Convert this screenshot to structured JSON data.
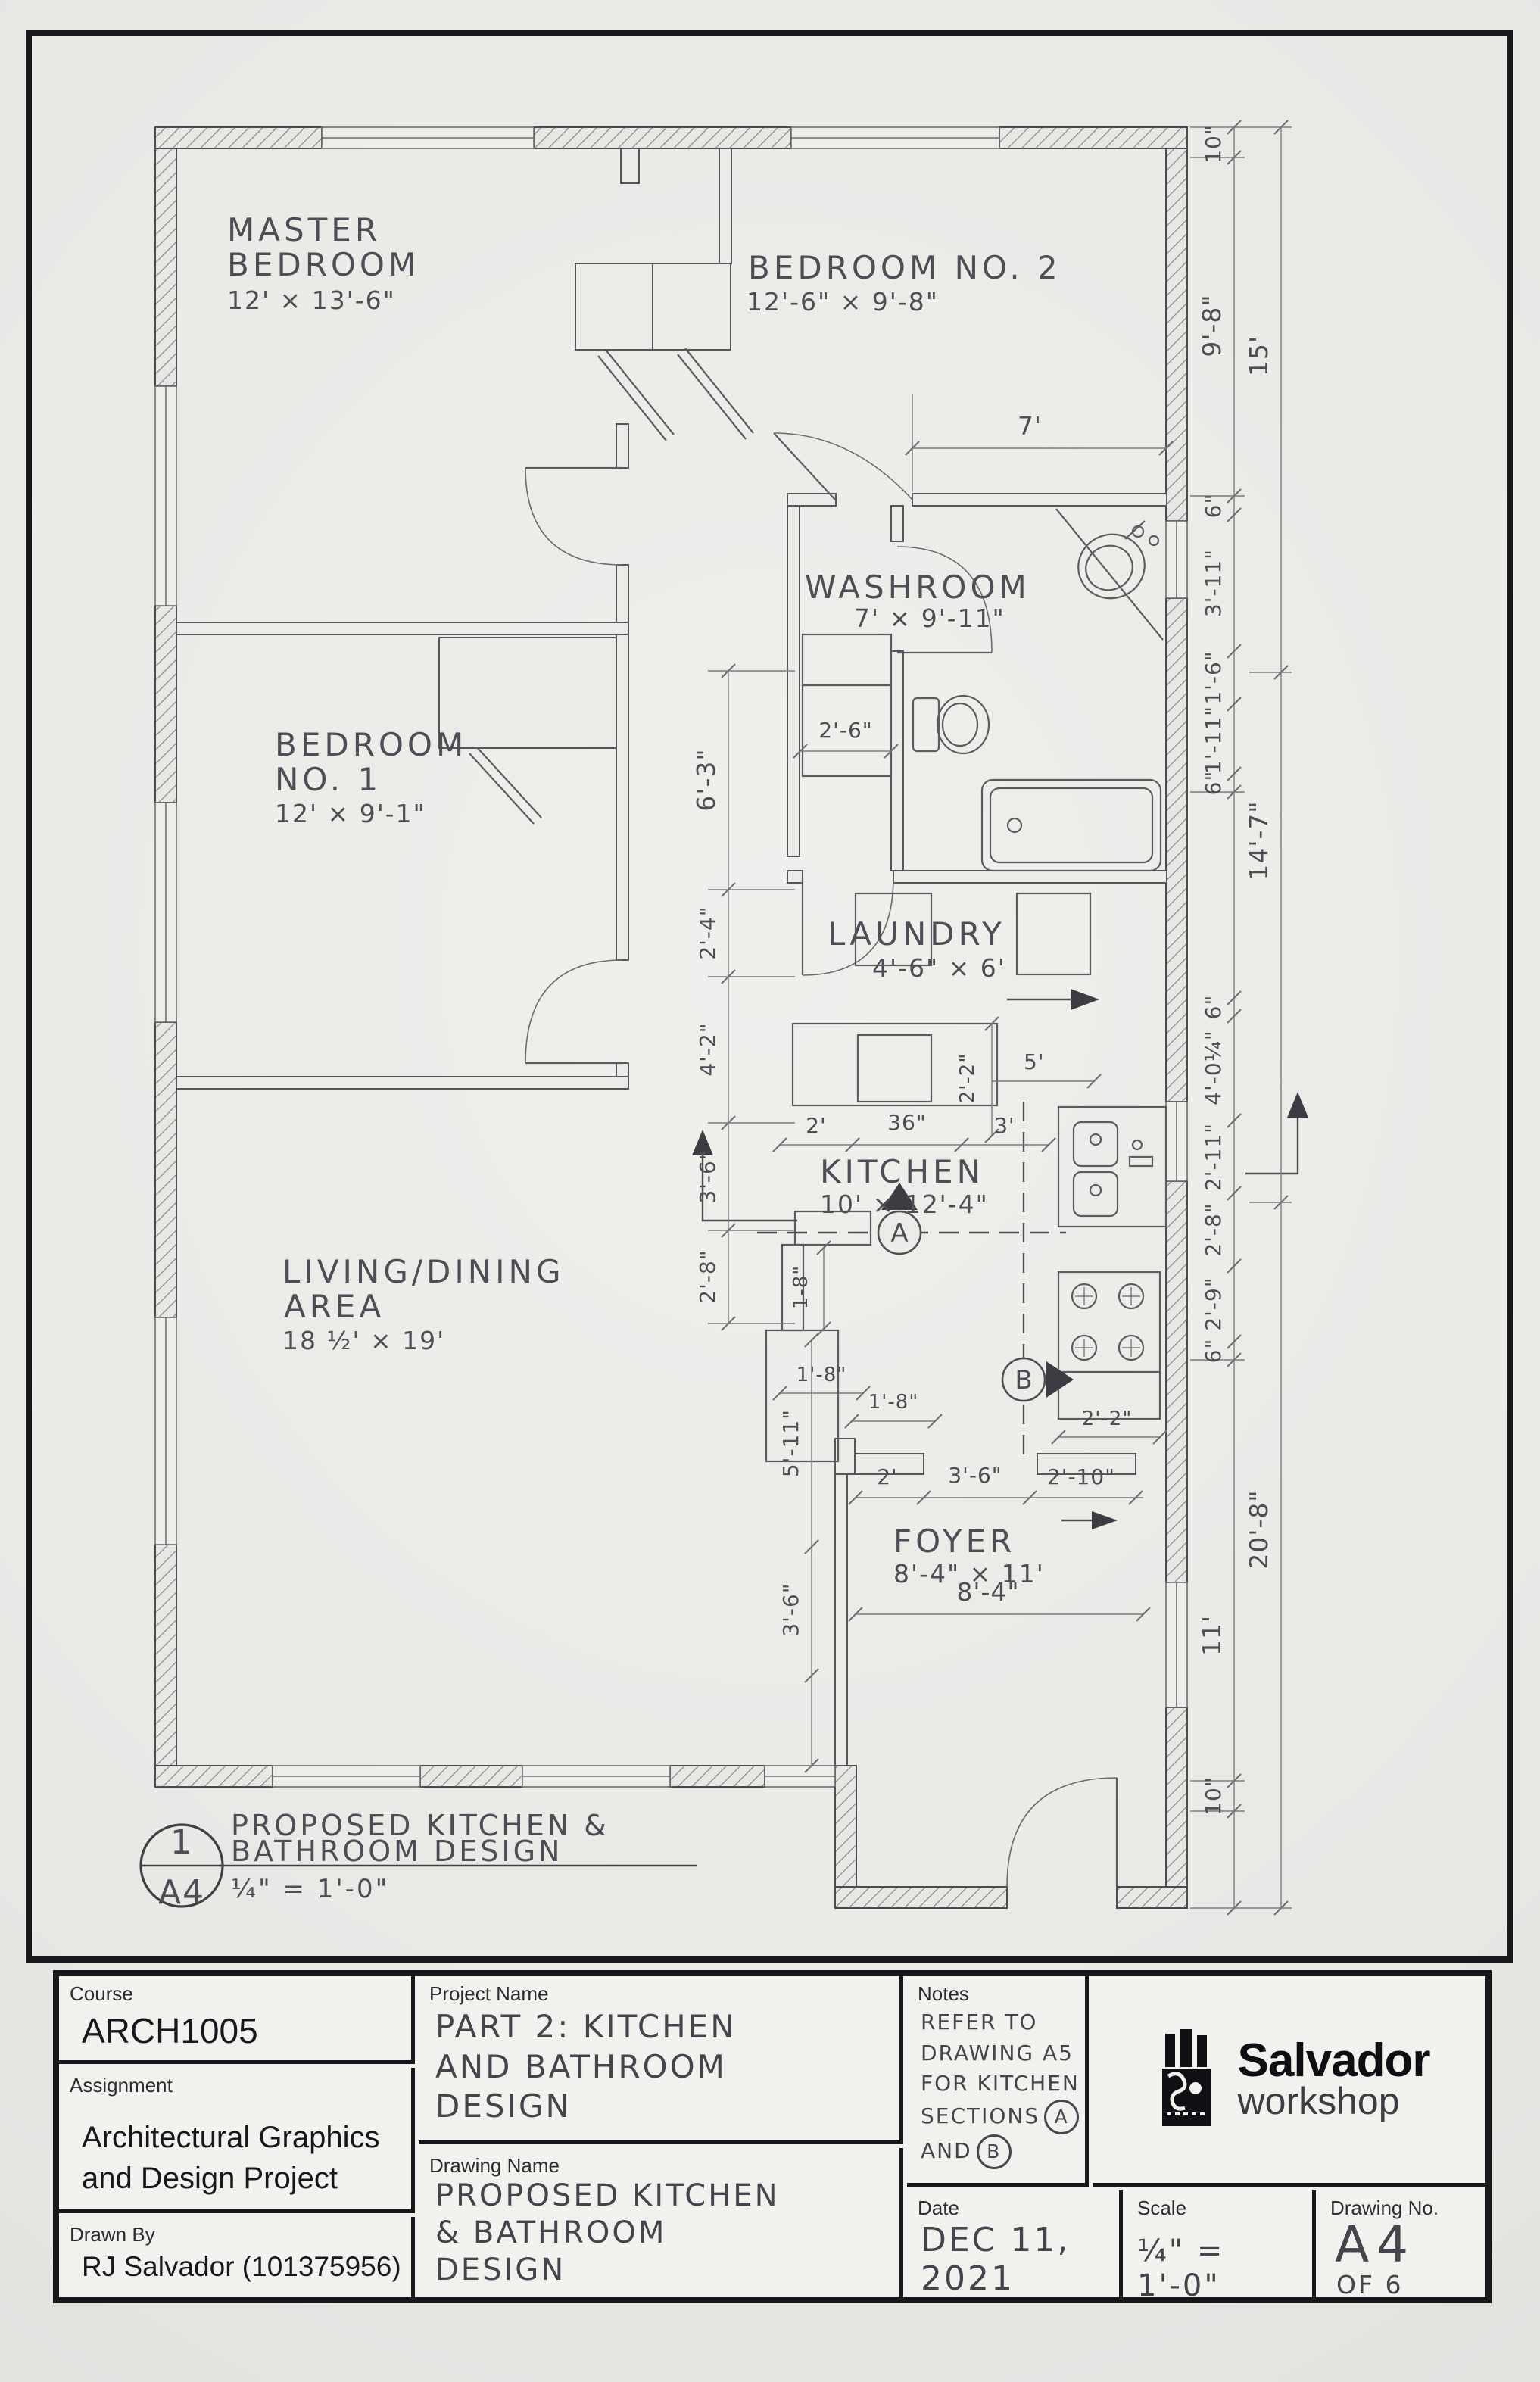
{
  "plan": {
    "rooms": {
      "master": {
        "l1": "MASTER",
        "l2": "BEDROOM",
        "dims": "12' × 13'-6\""
      },
      "bed2": {
        "l1": "BEDROOM NO. 2",
        "dims": "12'-6\" × 9'-8\""
      },
      "washroom": {
        "l1": "WASHROOM",
        "dims": "7' × 9'-11\""
      },
      "bed1": {
        "l1": "BEDROOM",
        "l2": "NO. 1",
        "dims": "12' × 9'-1\""
      },
      "laundry": {
        "l1": "LAUNDRY",
        "dims": "4'-6\" × 6'"
      },
      "kitchen": {
        "l1": "KITCHEN",
        "dims": "10' × 12'-4\""
      },
      "living": {
        "l1": "LIVING/DINING",
        "l2": "AREA",
        "dims": "18 ½' × 19'"
      },
      "foyer": {
        "l1": "FOYER",
        "dims": "8'-4\" × 11'"
      }
    },
    "dims": {
      "right_inner": [
        "10\"",
        "9'-8\"",
        "6\"",
        "3'-11\"",
        "1'-6\"",
        "1'-11\"",
        "6\"",
        "6\"",
        "4'-0¼\"",
        "2'-11\"",
        "2'-8\"",
        "2'-9\"",
        "6\"",
        "11'",
        "10\""
      ],
      "right_outer": [
        "15'",
        "14'-7\"",
        "20'-8\""
      ],
      "mid_vertical": [
        "6'-3\"",
        "2'-4\"",
        "4'-2\"",
        "3'-6\"",
        "2'-8\""
      ],
      "foyer_vertical": [
        "5'-11\"",
        "3'-6\""
      ],
      "washroom_closet": "2'-6\"",
      "bed2_width": "7'",
      "kitchen_top": [
        "2'",
        "36\"",
        "3'"
      ],
      "kitchen_5": "5'",
      "kitchen_2_2_a": "2'-2\"",
      "kitchen_2_2_b": "2'-2\"",
      "kitchen_1_8_a": "1-8\"",
      "kitchen_1_8_b": "1'-8\"",
      "kitchen_1_8_c": "1'-8\"",
      "foyer_top": [
        "2'",
        "3'-6\"",
        "2'-10\""
      ],
      "foyer_width": "8'-4\""
    },
    "sections": {
      "a": "A",
      "b": "B"
    },
    "callout": {
      "number": "1",
      "sheet": "A4",
      "title1": "PROPOSED KITCHEN &",
      "title2": "BATHROOM DESIGN",
      "scale": "¼\" = 1'-0\""
    }
  },
  "title_block": {
    "course_label": "Course",
    "course": "ARCH1005",
    "assignment_label": "Assignment",
    "assignment1": "Architectural Graphics",
    "assignment2": "and Design Project",
    "drawn_by_label": "Drawn By",
    "drawn_by": "RJ Salvador (101375956)",
    "project_label": "Project Name",
    "project1": "PART 2: KITCHEN",
    "project2": "AND BATHROOM",
    "project3": "DESIGN",
    "drawing_label": "Drawing Name",
    "drawing1": "PROPOSED KITCHEN",
    "drawing2": "& BATHROOM",
    "drawing3": "DESIGN",
    "notes_label": "Notes",
    "notes1": "REFER TO",
    "notes2": "DRAWING A5",
    "notes3": "FOR KITCHEN",
    "notes4": "SECTIONS",
    "notes4b": "A",
    "notes5": "AND",
    "notes5b": "B",
    "logo_title": "Salvador",
    "logo_sub": "workshop",
    "date_label": "Date",
    "date1": "DEC 11,",
    "date2": "2021",
    "scale_label": "Scale",
    "scale": "¼\" = 1'-0\"",
    "dwg_no_label": "Drawing No.",
    "dwg_no": "A4",
    "dwg_of": "OF 6"
  }
}
